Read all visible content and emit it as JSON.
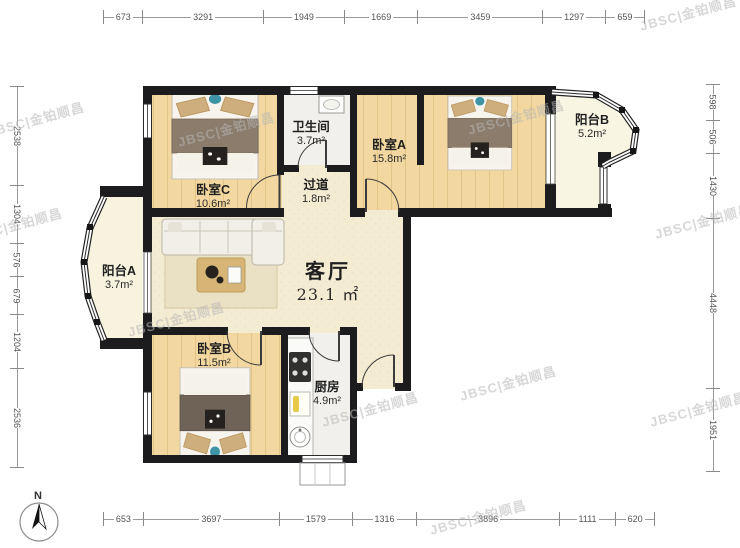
{
  "watermark": {
    "text": "JBSC|金铂顺昌"
  },
  "compass": {
    "label": "N"
  },
  "rooms": {
    "bedroomC": {
      "name": "卧室C",
      "area": "10.6m²"
    },
    "bathroom": {
      "name": "卫生间",
      "area": "3.7m²"
    },
    "hallway": {
      "name": "过道",
      "area": "1.8m²"
    },
    "bedroomA": {
      "name": "卧室A",
      "area": "15.8m²"
    },
    "balconyB": {
      "name": "阳台B",
      "area": "5.2m²"
    },
    "living": {
      "name": "客厅",
      "area": "23.1 ㎡"
    },
    "balconyA": {
      "name": "阳台A",
      "area": "3.7m²"
    },
    "bedroomB": {
      "name": "卧室B",
      "area": "11.5m²"
    },
    "kitchen": {
      "name": "厨房",
      "area": "4.9m²"
    }
  },
  "dims": {
    "top": [
      "673",
      "3291",
      "1949",
      "1669",
      "3459",
      "1297",
      "659"
    ],
    "bottom": [
      "653",
      "3697",
      "1579",
      "1316",
      "3896",
      "1111",
      "620"
    ],
    "left": [
      "2538",
      "1304",
      "576",
      "679",
      "1204",
      "2536"
    ],
    "right": [
      "598",
      "506",
      "1430",
      "4448",
      "1951"
    ]
  },
  "colors": {
    "wall": "#1c1c1e",
    "wood_floor": "#f2d8a0",
    "living_floor": "#f4ecd2",
    "wet_floor": "#f1f0ec",
    "balcony_floor": "#f9f5e3",
    "watermark_gray": "#b6b6b6",
    "bed_accent_teal": "#3e93a5"
  }
}
